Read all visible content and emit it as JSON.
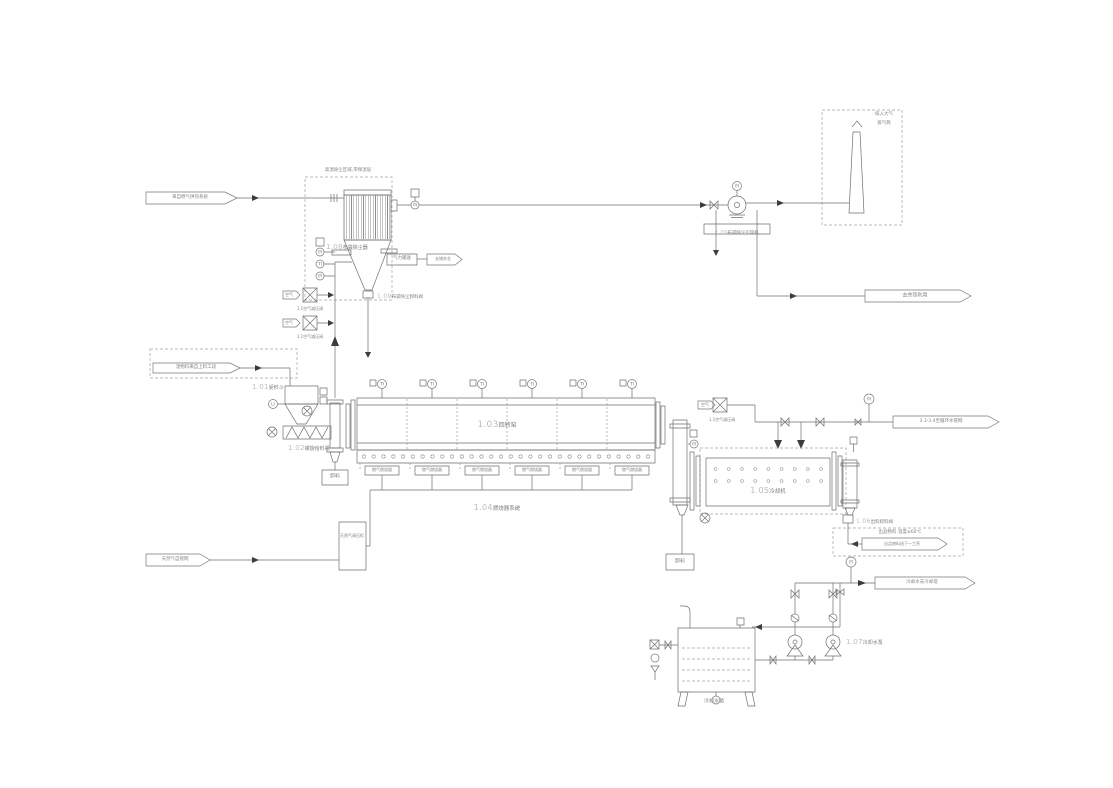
{
  "equipment": {
    "e101": {
      "tag": "1.01",
      "name": "受料斗"
    },
    "e102": {
      "tag": "1.02",
      "name": "螺旋给料机"
    },
    "e103": {
      "tag": "1.03",
      "name": "回转窑"
    },
    "e104": {
      "tag": "1.04",
      "name": "燃烧器系统"
    },
    "e105": {
      "tag": "1.05",
      "name": "冷却机"
    },
    "e106": {
      "tag": "1.06",
      "name": "出料卸料阀"
    },
    "e107": {
      "tag": "1.07",
      "name": "冷却水泵"
    },
    "e108": {
      "tag": "1.08",
      "name": "布袋除尘器"
    },
    "e109_valve": {
      "tag": "1.09",
      "name": "布袋除尘卸料阀"
    },
    "e109_fan": {
      "tag": "1.09",
      "name": "布袋除尘引风机"
    }
  },
  "connectors": {
    "fluegas_in": "来自燃气供热系统",
    "heat_out": "去余热利用",
    "ash_out": "去储灰仓",
    "wet_feed_in": "湿物料来自上料工段",
    "gas_in": "天然气自管网",
    "cw_network": "3.3-3.4至循环水管网",
    "product_out": "出品物料送下一工序",
    "cw_out": "冷却水去冷却塔",
    "vent_note": "排入大气",
    "stack_label": "排气筒"
  },
  "notes": {
    "baghouse_note": "高温除尘区域,带保温层",
    "product_note": "出品物料 温度≤60℃"
  },
  "devices": {
    "pneumatic_box": "气力输送",
    "burner_label": "燃气燃烧器",
    "gas_cabinet": "天然气调压柜",
    "air_flag": "空气",
    "air_valve_label": "1.1空气减压阀",
    "unload_box": "卸料",
    "tank_label": "冷却水箱"
  },
  "instruments": {
    "ti": "TI",
    "pi": "PI",
    "li": "LI"
  }
}
